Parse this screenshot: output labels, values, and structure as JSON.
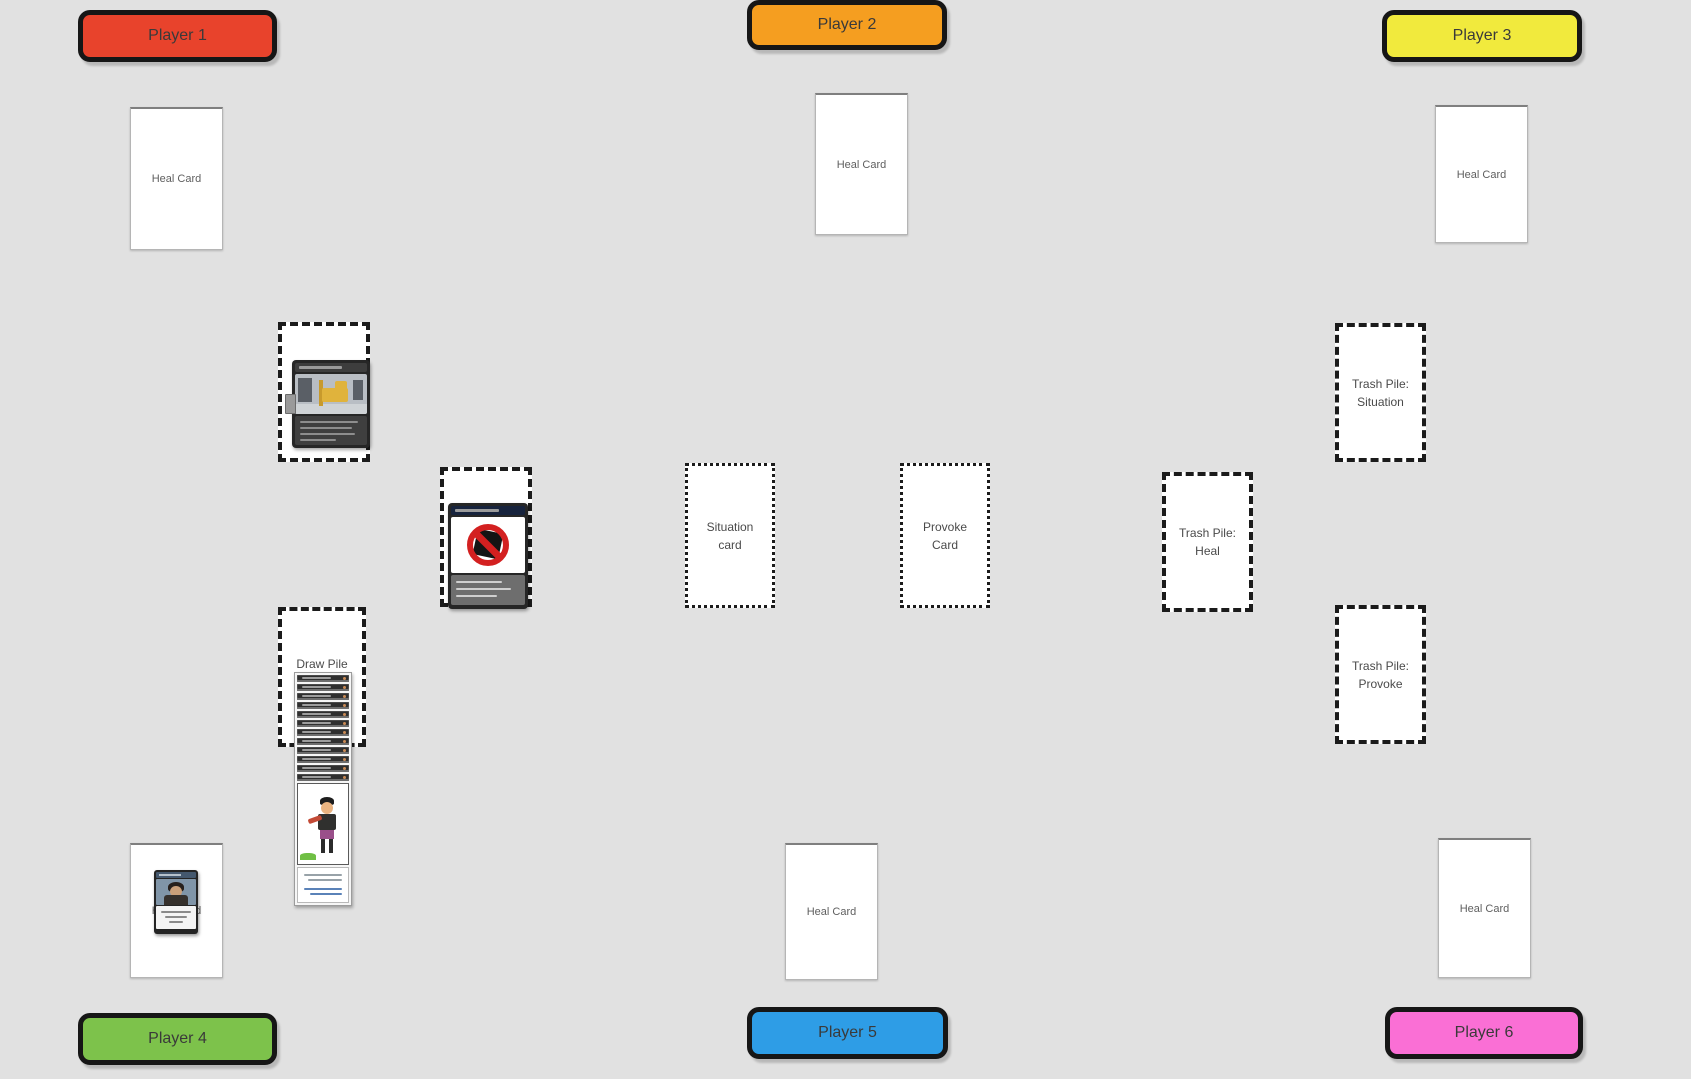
{
  "canvas": {
    "width": 1691,
    "height": 1079,
    "background": "#e1e1e1"
  },
  "players": [
    {
      "label": "Player 1",
      "color": "#e8432c"
    },
    {
      "label": "Player 2",
      "color": "#f59e20"
    },
    {
      "label": "Player 3",
      "color": "#f1ea3d"
    },
    {
      "label": "Player 4",
      "color": "#7dc24b"
    },
    {
      "label": "Player 5",
      "color": "#2e9de6"
    },
    {
      "label": "Player 6",
      "color": "#fa6fd5"
    }
  ],
  "cards": {
    "heal_label": "Heal Card"
  },
  "zones": {
    "situation_deck": "Situation\ncard",
    "provoke_deck": "Provoke\nCard",
    "trash_heal": "Trash Pile:\nHeal",
    "trash_situation": "Trash Pile:\nSituation",
    "trash_provoke": "Trash Pile:\nProvoke",
    "draw_pile": "Draw Pile"
  },
  "icons": {
    "no_entry_icon": "prohibition sign on played provoke card",
    "forklift_image": "forklift scene on played situation card",
    "character_image": "cartoon kid on revealed draw-pile card",
    "portrait_image": "photo portrait on mini card over player 4 heal card"
  }
}
